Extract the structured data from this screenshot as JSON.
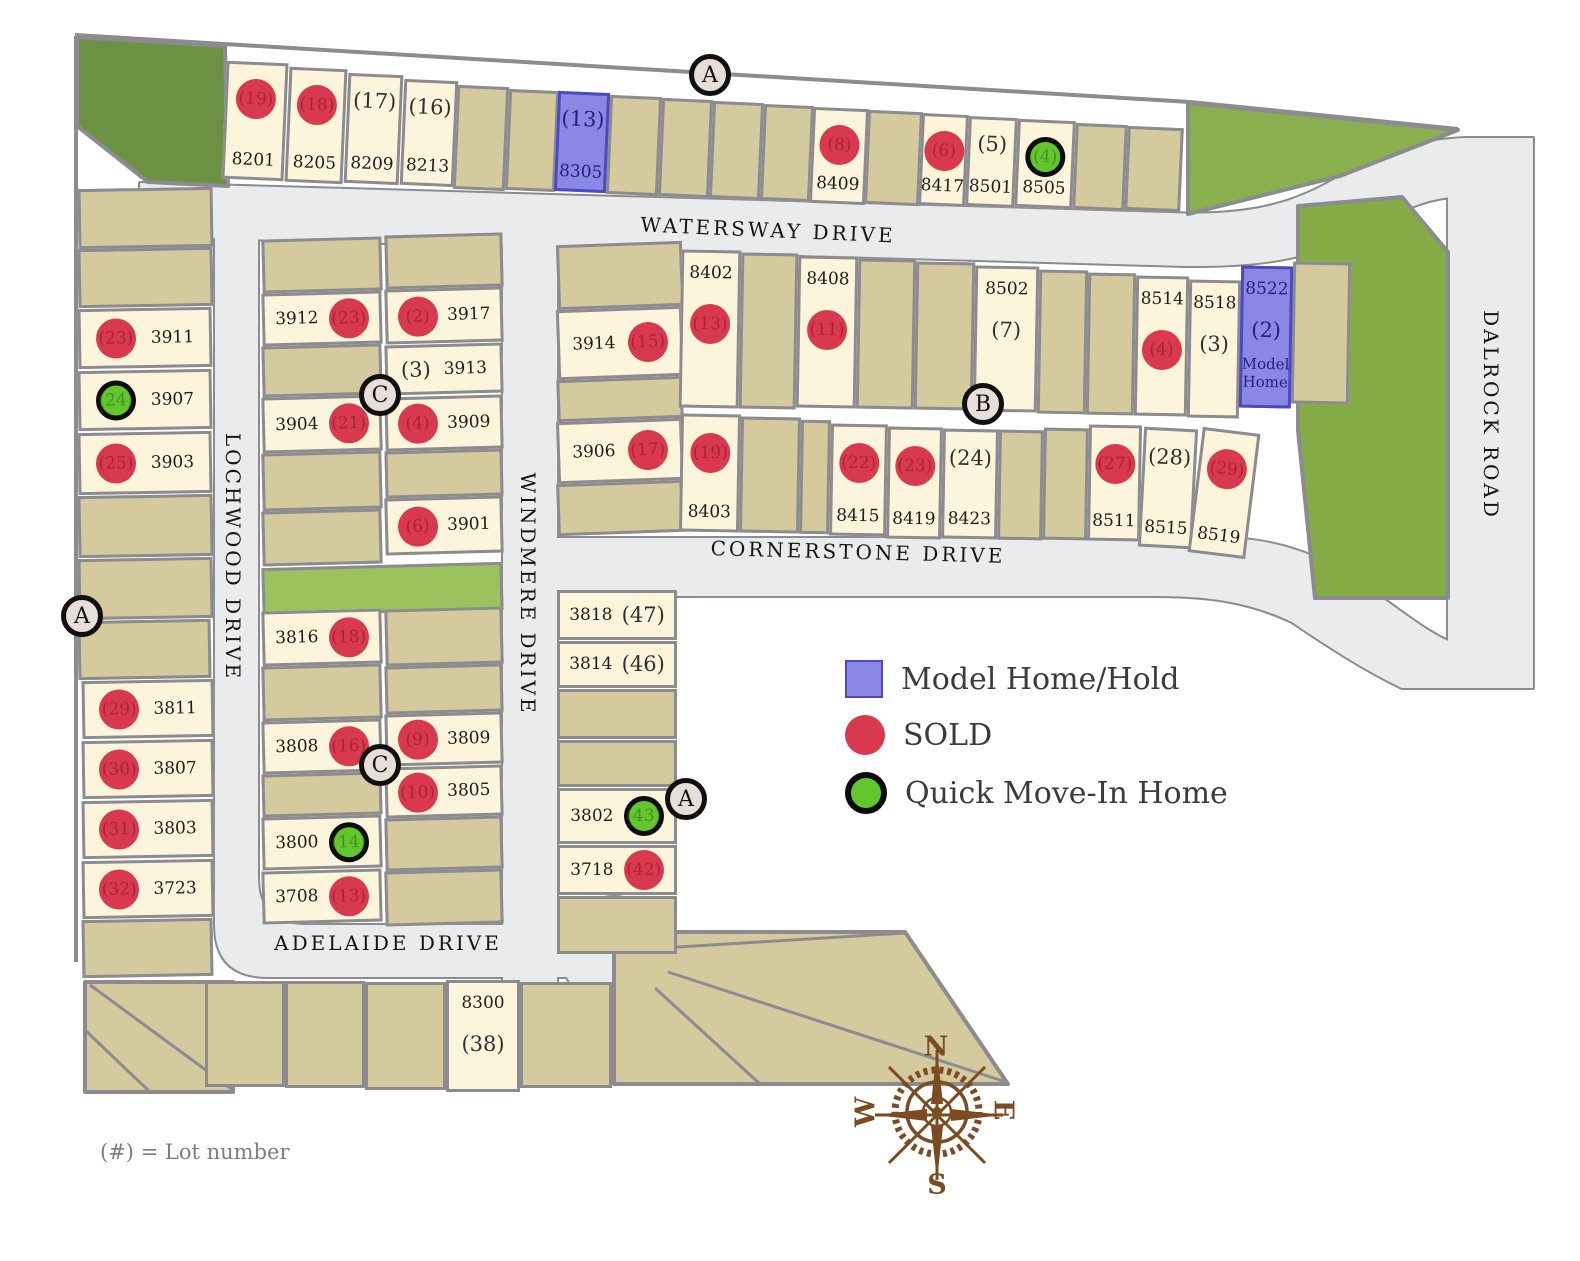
{
  "legend": {
    "items": [
      {
        "key": "model",
        "label": "Model Home/Hold"
      },
      {
        "key": "sold",
        "label": "SOLD"
      },
      {
        "key": "quick",
        "label": "Quick Move-In Home"
      }
    ]
  },
  "footnote": "(#) = Lot number",
  "streets": {
    "watersway": "WATERSWAY DRIVE",
    "cornerstone": "CORNERSTONE DRIVE",
    "adelaide": "ADELAIDE DRIVE",
    "lochwood": "LOCHWOOD DRIVE",
    "windmere": "WINDMERE DRIVE",
    "dalrock": "DALROCK ROAD"
  },
  "compass": {
    "north": "N",
    "east": "E",
    "south": "S",
    "west": "W"
  },
  "colors": {
    "sold": "#d9394e",
    "quick_fill": "#63c62e",
    "model_fill": "#8a88e4",
    "model_border": "#4d49c0",
    "model_text": "#232082",
    "cream_lot": "#fdf5db",
    "tan_lot": "#d5c99e",
    "road": "#e9ebec",
    "border_gray": "#8b8b90",
    "park_green": "#85ab47",
    "park_dark_green": "#6d9143",
    "compass_brown": "#7b4b21"
  },
  "map": {
    "markers": [
      {
        "label": "A",
        "x": 710,
        "y": 75
      },
      {
        "label": "A",
        "x": 82,
        "y": 616
      },
      {
        "label": "A",
        "x": 686,
        "y": 799
      },
      {
        "label": "B",
        "x": 983,
        "y": 404
      },
      {
        "label": "C",
        "x": 380,
        "y": 395
      },
      {
        "label": "C",
        "x": 380,
        "y": 765
      }
    ],
    "lots": [
      {
        "address": "8201",
        "lot": "(19)",
        "status": "sold",
        "dir": "col-ct",
        "x": 224,
        "y": 62,
        "w": 62,
        "h": 118,
        "rot": 2.5
      },
      {
        "address": "8205",
        "lot": "(18)",
        "status": "sold",
        "dir": "col-ct",
        "x": 287,
        "y": 68,
        "w": 58,
        "h": 115,
        "rot": 2.5
      },
      {
        "address": "8209",
        "lot": "(17)",
        "status": "open",
        "dir": "col-ct",
        "x": 346,
        "y": 74,
        "w": 55,
        "h": 110,
        "rot": 2.5
      },
      {
        "address": "8213",
        "lot": "(16)",
        "status": "open",
        "dir": "col-ct",
        "x": 402,
        "y": 80,
        "w": 54,
        "h": 106,
        "rot": 2.5
      },
      {
        "address": "8305",
        "lot": "(13)",
        "status": "model",
        "dir": "col-ct",
        "x": 556,
        "y": 92,
        "w": 52,
        "h": 100,
        "rot": 2.5
      },
      {
        "address": "8409",
        "lot": "(8)",
        "status": "sold",
        "dir": "col-ct",
        "x": 811,
        "y": 108,
        "w": 56,
        "h": 96,
        "rot": 2.5
      },
      {
        "address": "8417",
        "lot": "(6)",
        "status": "sold",
        "dir": "col-ct",
        "x": 920,
        "y": 114,
        "w": 47,
        "h": 92,
        "rot": 2.5
      },
      {
        "address": "8501",
        "lot": "(5)",
        "status": "open",
        "dir": "col-ct",
        "x": 967,
        "y": 117,
        "w": 49,
        "h": 90,
        "rot": 2.5
      },
      {
        "address": "8505",
        "lot": "(4)",
        "status": "quick",
        "dir": "col-ct",
        "x": 1016,
        "y": 120,
        "w": 58,
        "h": 88,
        "rot": 2.5
      },
      {
        "address": "3911",
        "lot": "(23)",
        "status": "sold",
        "dir": "row-cl",
        "x": 78,
        "y": 308,
        "w": 134,
        "h": 60,
        "rot": -1
      },
      {
        "address": "3907",
        "lot": "(24)",
        "status": "quick",
        "dir": "row-cl",
        "x": 78,
        "y": 370,
        "w": 134,
        "h": 60,
        "rot": -1
      },
      {
        "address": "3903",
        "lot": "(25)",
        "status": "sold",
        "dir": "row-cl",
        "x": 78,
        "y": 432,
        "w": 134,
        "h": 62,
        "rot": -1
      },
      {
        "address": "3811",
        "lot": "(29)",
        "status": "sold",
        "dir": "row-cl",
        "x": 82,
        "y": 680,
        "w": 132,
        "h": 58,
        "rot": -1
      },
      {
        "address": "3807",
        "lot": "(30)",
        "status": "sold",
        "dir": "row-cl",
        "x": 82,
        "y": 740,
        "w": 132,
        "h": 58,
        "rot": -1
      },
      {
        "address": "3803",
        "lot": "(31)",
        "status": "sold",
        "dir": "row-cl",
        "x": 82,
        "y": 800,
        "w": 132,
        "h": 58,
        "rot": -1
      },
      {
        "address": "3723",
        "lot": "(32)",
        "status": "sold",
        "dir": "row-cl",
        "x": 82,
        "y": 860,
        "w": 132,
        "h": 58,
        "rot": -1
      },
      {
        "address": "3912",
        "lot": "(23)",
        "status": "sold",
        "dir": "row-cr",
        "x": 262,
        "y": 292,
        "w": 120,
        "h": 53,
        "rot": -1.5
      },
      {
        "address": "3904",
        "lot": "(21)",
        "status": "sold",
        "dir": "row-cr",
        "x": 262,
        "y": 396,
        "w": 120,
        "h": 56,
        "rot": -1.5
      },
      {
        "address": "3816",
        "lot": "(18)",
        "status": "sold",
        "dir": "row-cr",
        "x": 262,
        "y": 610,
        "w": 120,
        "h": 55,
        "rot": -1.5
      },
      {
        "address": "3808",
        "lot": "(16)",
        "status": "sold",
        "dir": "row-cr",
        "x": 262,
        "y": 720,
        "w": 120,
        "h": 53,
        "rot": -1.5
      },
      {
        "address": "3800",
        "lot": "(14)",
        "status": "quick",
        "dir": "row-cr",
        "x": 262,
        "y": 816,
        "w": 120,
        "h": 53,
        "rot": -1.5
      },
      {
        "address": "3708",
        "lot": "(13)",
        "status": "sold",
        "dir": "row-cr",
        "x": 262,
        "y": 870,
        "w": 120,
        "h": 53,
        "rot": -1.5
      },
      {
        "address": "3917",
        "lot": "(2)",
        "status": "sold",
        "dir": "row-cl",
        "x": 385,
        "y": 288,
        "w": 118,
        "h": 55,
        "rot": -1.5
      },
      {
        "address": "3913",
        "lot": "(3)",
        "status": "open",
        "dir": "row-cl",
        "x": 385,
        "y": 344,
        "w": 118,
        "h": 50,
        "rot": -1.5
      },
      {
        "address": "3909",
        "lot": "(4)",
        "status": "sold",
        "dir": "row-cl",
        "x": 385,
        "y": 396,
        "w": 118,
        "h": 54,
        "rot": -1.5
      },
      {
        "address": "3901",
        "lot": "(6)",
        "status": "sold",
        "dir": "row-cl",
        "x": 385,
        "y": 497,
        "w": 118,
        "h": 57,
        "rot": -1.5
      },
      {
        "address": "3809",
        "lot": "(9)",
        "status": "sold",
        "dir": "row-cl",
        "x": 385,
        "y": 713,
        "w": 118,
        "h": 52,
        "rot": -1.5
      },
      {
        "address": "3805",
        "lot": "(10)",
        "status": "sold",
        "dir": "row-cl",
        "x": 385,
        "y": 766,
        "w": 118,
        "h": 51,
        "rot": -1.5
      },
      {
        "address": "3914",
        "lot": "(15)",
        "status": "sold",
        "dir": "row-cr",
        "x": 557,
        "y": 308,
        "w": 126,
        "h": 70,
        "rot": -2
      },
      {
        "address": "3906",
        "lot": "(17)",
        "status": "sold",
        "dir": "row-cr",
        "x": 557,
        "y": 420,
        "w": 126,
        "h": 62,
        "rot": -2
      },
      {
        "address": "8402",
        "lot": "(13)",
        "status": "sold",
        "dir": "col-at",
        "x": 680,
        "y": 250,
        "w": 60,
        "h": 158,
        "rot": 1
      },
      {
        "address": "8408",
        "lot": "(11)",
        "status": "sold",
        "dir": "col-at",
        "x": 797,
        "y": 256,
        "w": 60,
        "h": 152,
        "rot": 1
      },
      {
        "address": "8502",
        "lot": "(7)",
        "status": "open",
        "dir": "col-at",
        "x": 974,
        "y": 266,
        "w": 64,
        "h": 146,
        "rot": 1
      },
      {
        "address": "8514",
        "lot": "(4)",
        "status": "sold",
        "dir": "col-at",
        "x": 1135,
        "y": 276,
        "w": 53,
        "h": 140,
        "rot": 1
      },
      {
        "address": "8518",
        "lot": "(3)",
        "status": "open",
        "dir": "col-at",
        "x": 1188,
        "y": 280,
        "w": 52,
        "h": 138,
        "rot": 1
      },
      {
        "address": "8522",
        "lot": "(2)",
        "status": "model",
        "dir": "col-at",
        "x": 1240,
        "y": 266,
        "w": 52,
        "h": 142,
        "rot": 1,
        "note": "Model Home"
      },
      {
        "address": "8403",
        "lot": "(19)",
        "status": "sold",
        "dir": "col-cb",
        "x": 680,
        "y": 414,
        "w": 60,
        "h": 118,
        "rot": 1
      },
      {
        "address": "8415",
        "lot": "(22)",
        "status": "sold",
        "dir": "col-cb",
        "x": 830,
        "y": 424,
        "w": 57,
        "h": 112,
        "rot": 1
      },
      {
        "address": "8419",
        "lot": "(23)",
        "status": "sold",
        "dir": "col-cb",
        "x": 887,
        "y": 427,
        "w": 55,
        "h": 112,
        "rot": 1
      },
      {
        "address": "8423",
        "lot": "(24)",
        "status": "open",
        "dir": "col-cb",
        "x": 942,
        "y": 429,
        "w": 56,
        "h": 110,
        "rot": 1
      },
      {
        "address": "8511",
        "lot": "(27)",
        "status": "sold",
        "dir": "col-cb",
        "x": 1088,
        "y": 425,
        "w": 53,
        "h": 116,
        "rot": 1
      },
      {
        "address": "8515",
        "lot": "(28)",
        "status": "open",
        "dir": "col-cb",
        "x": 1141,
        "y": 428,
        "w": 54,
        "h": 120,
        "rot": 3
      },
      {
        "address": "8519",
        "lot": "(29)",
        "status": "sold",
        "dir": "col-cb",
        "x": 1195,
        "y": 430,
        "w": 58,
        "h": 126,
        "rot": 7
      },
      {
        "address": "3818",
        "lot": "(47)",
        "status": "open",
        "dir": "row-cr",
        "x": 557,
        "y": 590,
        "w": 120,
        "h": 50,
        "rot": 0
      },
      {
        "address": "3814",
        "lot": "(46)",
        "status": "open",
        "dir": "row-cr",
        "x": 557,
        "y": 641,
        "w": 120,
        "h": 47,
        "rot": 0
      },
      {
        "address": "3802",
        "lot": "(43)",
        "status": "quick",
        "dir": "row-cr",
        "x": 557,
        "y": 788,
        "w": 120,
        "h": 56,
        "rot": 0
      },
      {
        "address": "3718",
        "lot": "(42)",
        "status": "sold",
        "dir": "row-cr",
        "x": 557,
        "y": 845,
        "w": 120,
        "h": 50,
        "rot": 0
      },
      {
        "address": "8300",
        "lot": "(38)",
        "status": "open",
        "dir": "col-at",
        "x": 446,
        "y": 980,
        "w": 74,
        "h": 112,
        "rot": 0
      }
    ],
    "parcels": [
      [
        455,
        86,
        52,
        104,
        2.5
      ],
      [
        507,
        90,
        50,
        101,
        2.5
      ],
      [
        608,
        96,
        52,
        99,
        2.5
      ],
      [
        660,
        99,
        51,
        98,
        2.5
      ],
      [
        711,
        102,
        51,
        97,
        2.5
      ],
      [
        762,
        105,
        50,
        96,
        2.5
      ],
      [
        866,
        111,
        55,
        94,
        2.5
      ],
      [
        1074,
        124,
        52,
        86,
        2.5
      ],
      [
        1126,
        127,
        56,
        84,
        2.5
      ],
      [
        78,
        188,
        135,
        60,
        -1
      ],
      [
        78,
        248,
        135,
        59,
        -1
      ],
      [
        78,
        495,
        135,
        62,
        -1
      ],
      [
        78,
        558,
        135,
        61,
        -1
      ],
      [
        78,
        620,
        133,
        59,
        -1
      ],
      [
        82,
        919,
        131,
        58,
        -1
      ],
      [
        262,
        238,
        120,
        54,
        -1.5
      ],
      [
        385,
        234,
        118,
        54,
        -1.5
      ],
      [
        262,
        345,
        120,
        51,
        -1.5
      ],
      [
        262,
        452,
        120,
        58,
        -1.5
      ],
      [
        385,
        450,
        118,
        47,
        -1.5
      ],
      [
        262,
        510,
        120,
        55,
        -1.5
      ],
      [
        385,
        608,
        118,
        57,
        -1.5
      ],
      [
        262,
        665,
        120,
        55,
        -1.5
      ],
      [
        385,
        665,
        118,
        48,
        -1.5
      ],
      [
        262,
        773,
        120,
        43,
        -1.5
      ],
      [
        385,
        817,
        118,
        53,
        -1.5
      ],
      [
        385,
        870,
        118,
        55,
        -1.5
      ],
      [
        557,
        243,
        126,
        65,
        -2
      ],
      [
        557,
        378,
        126,
        42,
        -2
      ],
      [
        557,
        482,
        126,
        52,
        -2
      ],
      [
        740,
        253,
        57,
        156,
        1
      ],
      [
        857,
        259,
        58,
        150,
        1
      ],
      [
        915,
        262,
        59,
        148,
        1
      ],
      [
        1038,
        270,
        49,
        144,
        1
      ],
      [
        1087,
        273,
        48,
        142,
        1
      ],
      [
        1292,
        262,
        58,
        142,
        1
      ],
      [
        740,
        417,
        60,
        116,
        1
      ],
      [
        800,
        420,
        30,
        114,
        1
      ],
      [
        998,
        430,
        45,
        110,
        1
      ],
      [
        1043,
        428,
        45,
        112,
        1
      ],
      [
        557,
        689,
        120,
        50,
        0
      ],
      [
        557,
        740,
        120,
        47,
        0
      ],
      [
        557,
        896,
        120,
        58,
        0
      ],
      [
        205,
        981,
        80,
        106,
        0
      ],
      [
        285,
        981,
        80,
        107,
        0
      ],
      [
        365,
        982,
        81,
        108,
        0
      ],
      [
        520,
        982,
        92,
        106,
        0
      ]
    ]
  }
}
